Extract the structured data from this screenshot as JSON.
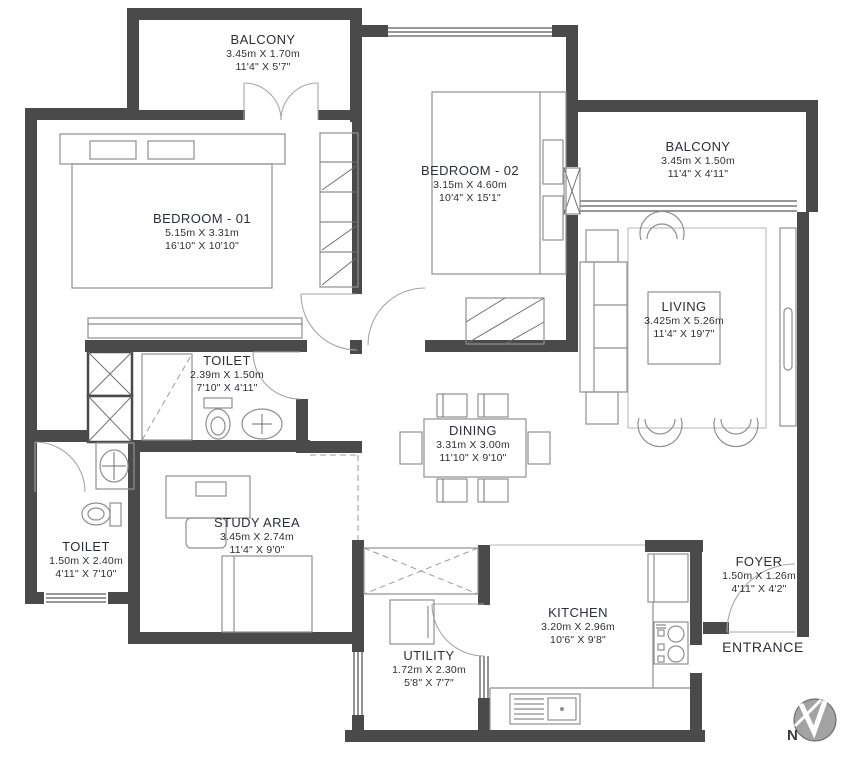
{
  "plan_title": "Apartment Floor Plan",
  "rooms": [
    {
      "id": "balcony-top-left",
      "name": "BALCONY",
      "metric": "3.45m X 1.70m",
      "imperial": "11'4\" X 5'7\""
    },
    {
      "id": "bedroom-01",
      "name": "BEDROOM - 01",
      "metric": "5.15m X 3.31m",
      "imperial": "16'10\" X 10'10\""
    },
    {
      "id": "bedroom-02",
      "name": "BEDROOM - 02",
      "metric": "3.15m X 4.60m",
      "imperial": "10'4\" X 15'1\""
    },
    {
      "id": "balcony-top-right",
      "name": "BALCONY",
      "metric": "3.45m X 1.50m",
      "imperial": "11'4\" X 4'11\""
    },
    {
      "id": "living",
      "name": "LIVING",
      "metric": "3.425m X 5.26m",
      "imperial": "11'4\" X 19'7\""
    },
    {
      "id": "toilet-upper",
      "name": "TOILET",
      "metric": "2.39m X 1.50m",
      "imperial": "7'10\" X 4'11\""
    },
    {
      "id": "dining",
      "name": "DINING",
      "metric": "3.31m X 3.00m",
      "imperial": "11'10\" X 9'10\""
    },
    {
      "id": "study-area",
      "name": "STUDY AREA",
      "metric": "3.45m X 2.74m",
      "imperial": "11'4\" X 9'0\""
    },
    {
      "id": "toilet-lower",
      "name": "TOILET",
      "metric": "1.50m X 2.40m",
      "imperial": "4'11\" X 7'10\""
    },
    {
      "id": "kitchen",
      "name": "KITCHEN",
      "metric": "3.20m X 2.96m",
      "imperial": "10'6\" X 9'8\""
    },
    {
      "id": "foyer",
      "name": "FOYER",
      "metric": "1.50m X 1.26m",
      "imperial": "4'11\" X 4'2\""
    },
    {
      "id": "utility",
      "name": "UTILITY",
      "metric": "1.72m X 2.30m",
      "imperial": "5'8\" X 7'7\""
    }
  ],
  "labels": {
    "entrance": "ENTRANCE",
    "north": "N"
  },
  "colors": {
    "wall": "#4a4a4a",
    "furniture_line": "#8f8f8f",
    "text": "#2d2f36",
    "background": "#ffffff",
    "north_fill": "#a3a3a3"
  }
}
